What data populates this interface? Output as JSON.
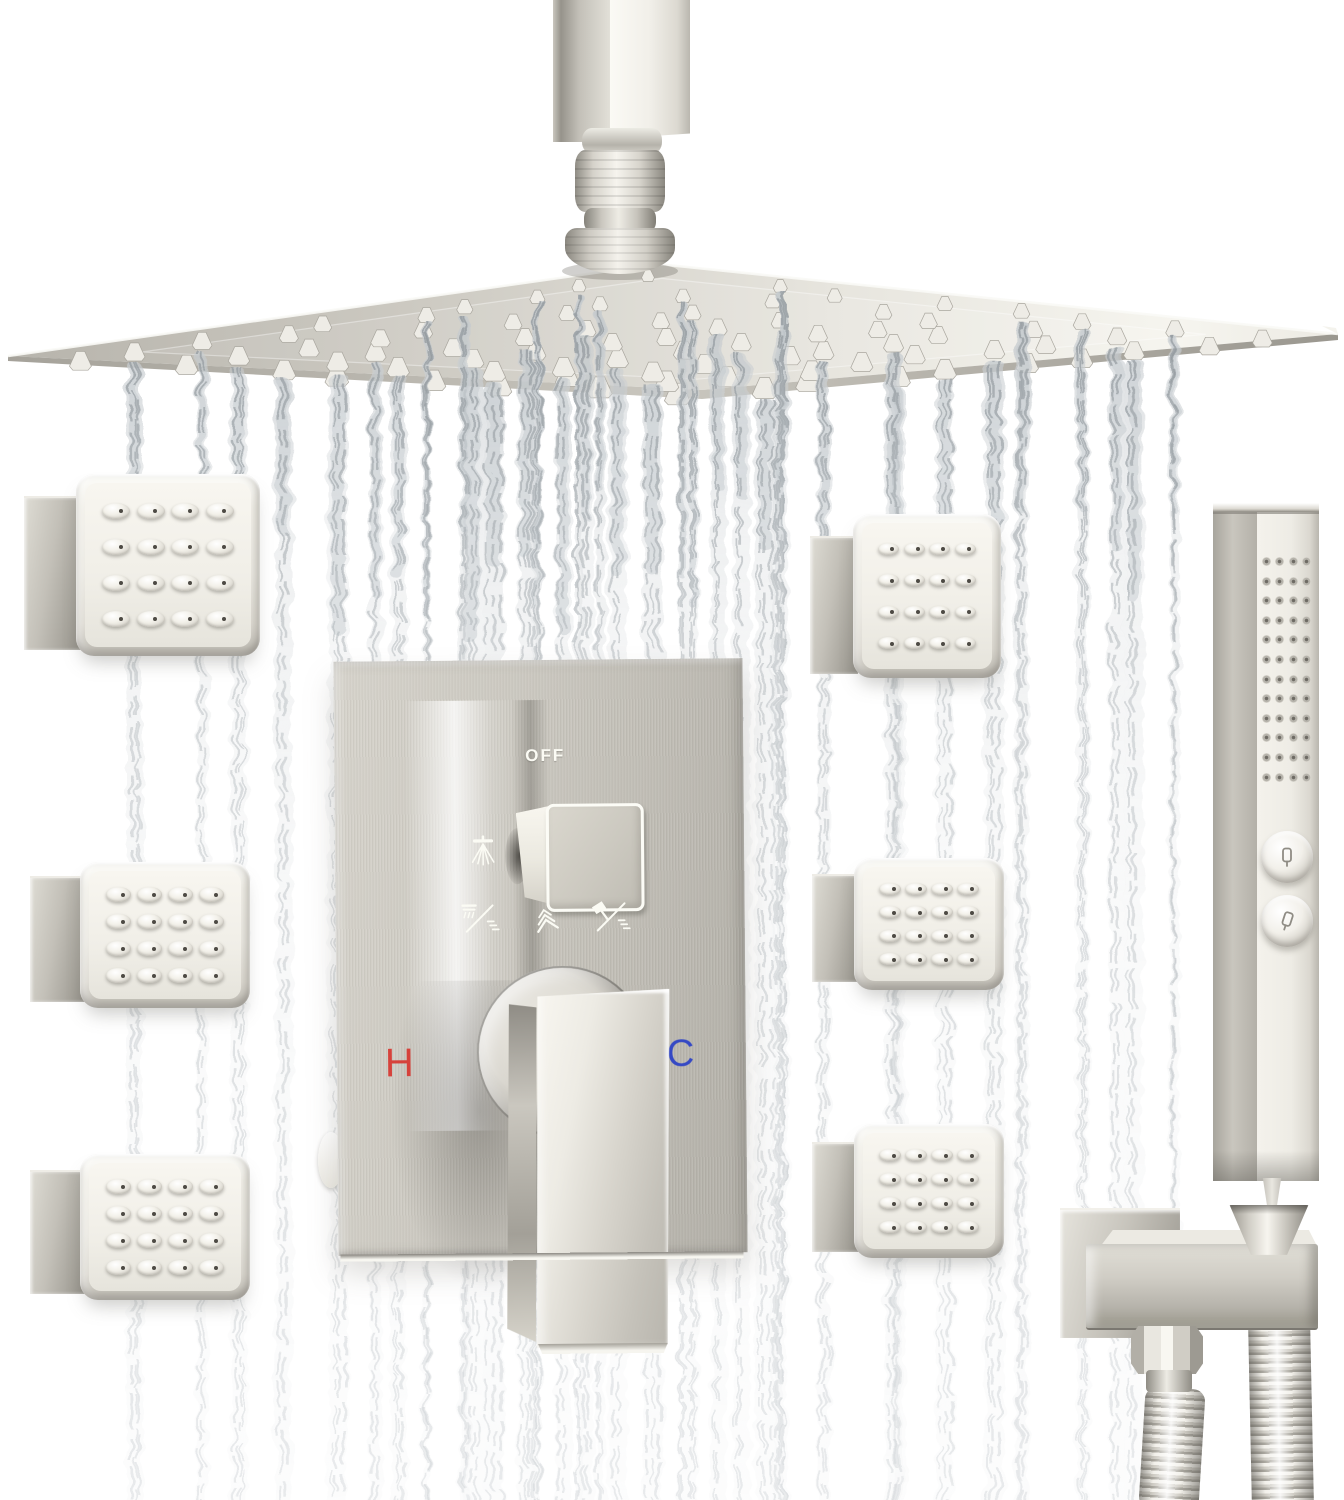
{
  "scene": {
    "description": "Brushed nickel ceiling-mount rain shower system: square rainfall shower head with falling water streams, six square body-spray jets, wall diverter valve trim with lever handle, and square handheld shower resting in a wall holder with flexible hoses",
    "background_color": "#ffffff",
    "finish": {
      "nickel_light": "#f2f0ea",
      "nickel_mid": "#c9c6be",
      "nickel_dark": "#a3a098",
      "water_tint": "#c3c9ce"
    }
  },
  "valve": {
    "off_label": "OFF",
    "hot_label": "H",
    "cold_label": "C",
    "hot_color": "#d6423b",
    "cold_color": "#3549c4",
    "diverter_icon": "rain-spray-icon",
    "mode_icons": [
      "rain-over-jets-mode-icon",
      "body-jets-mode-icon",
      "handheld-over-jets-mode-icon"
    ]
  },
  "components": {
    "body_jet_count": 6,
    "jet_nozzle_grid": "4x4",
    "handheld_nozzle_grid": "4x12",
    "handheld_button_count": 2,
    "rain_head_shape": "square",
    "mount": "ceiling"
  }
}
